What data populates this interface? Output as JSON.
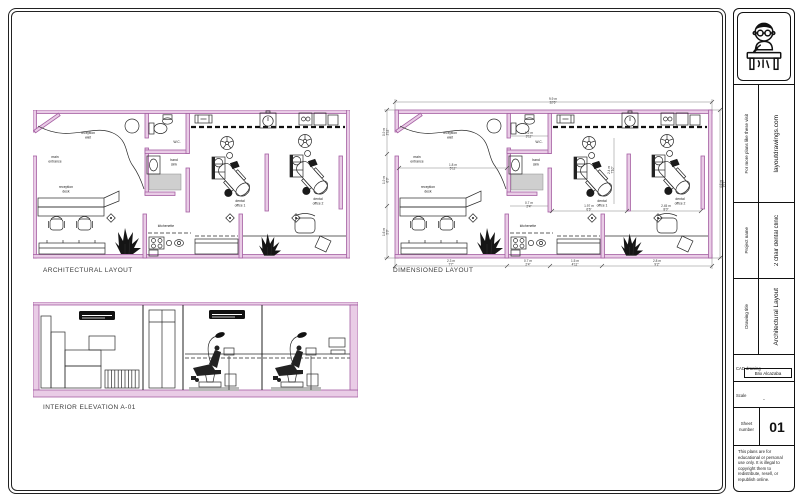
{
  "colors": {
    "wall_fill": "#e9cce6",
    "wall_stroke": "#a55fa3",
    "line": "#2b2b2b",
    "dim": "#777777"
  },
  "drawings": {
    "architectural_title": "ARCHITECTURAL LAYOUT",
    "dimensioned_title": "DIMENSIONED LAYOUT",
    "elevation_title": "INTERIOR ELEVATION A-01"
  },
  "plan_labels": {
    "reception_wait": [
      "reception",
      "wait"
    ],
    "main_entrance": [
      "main",
      "entrance"
    ],
    "wc": "W.C.",
    "hand_sink": [
      "hand",
      "sink"
    ],
    "reception_desk": [
      "reception",
      "desk"
    ],
    "kitchenette": "kitchenette",
    "dental_office_1": [
      "dental",
      "office 1"
    ],
    "dental_office_2": [
      "dental",
      "office 2"
    ]
  },
  "dimensions": [
    {
      "x": 158,
      "y": -10,
      "m": "9.9 m",
      "ft": "32'6\""
    },
    {
      "x": -10,
      "y": 22,
      "rot": -90,
      "m": "0.9 m",
      "ft": "2'11\""
    },
    {
      "x": -10,
      "y": 70,
      "rot": -90,
      "m": "1.9 m",
      "ft": "6'3\""
    },
    {
      "x": -10,
      "y": 122,
      "rot": -90,
      "m": "1.6 m",
      "ft": "5'3\""
    },
    {
      "x": 327,
      "y": 74,
      "rot": -90,
      "m": "4.6 m",
      "ft": "15'1\""
    },
    {
      "x": 56,
      "y": 152,
      "m": "2.3 m",
      "ft": "7'7\""
    },
    {
      "x": 133,
      "y": 152,
      "m": "0.7 m",
      "ft": "2'4\""
    },
    {
      "x": 180,
      "y": 152,
      "m": "1.5 m",
      "ft": "4'11\""
    },
    {
      "x": 262,
      "y": 152,
      "m": "2.8 m",
      "ft": "9'2\""
    },
    {
      "x": 58,
      "y": 56,
      "m": "1.8 m",
      "ft": "5'11\""
    },
    {
      "x": 134,
      "y": 24,
      "m": "1.2 m",
      "ft": "3'11\""
    },
    {
      "x": 134,
      "y": 94,
      "m": "0.7 m",
      "ft": "2'4\""
    },
    {
      "x": 194,
      "y": 97,
      "m": "1.97 m",
      "ft": "6'6\""
    },
    {
      "x": 271,
      "y": 97,
      "m": "2.45 m",
      "ft": "8'0\""
    },
    {
      "x": 215,
      "y": 60,
      "rot": -90,
      "m": "2.4 m",
      "ft": "7'10\""
    }
  ],
  "titleblock": {
    "promo_label": "For more plans like these visit",
    "promo_site": "layoutdrawings.com",
    "project_label": "Project name",
    "project_value": "2 chair dental clinic",
    "drawing_label": "Drawing title",
    "drawing_value": "Architectural Layout",
    "cad_label": "CAD drawing",
    "cad_value": "Brix Alcazaba",
    "scale_label": "Scale",
    "scale_value": "-",
    "sheet_label": [
      "Sheet",
      "number"
    ],
    "sheet_value": "01",
    "disclaimer": "This plans are for educational or personal use only. It is illegal to copyright them to redistribute, resell, or republish online."
  }
}
